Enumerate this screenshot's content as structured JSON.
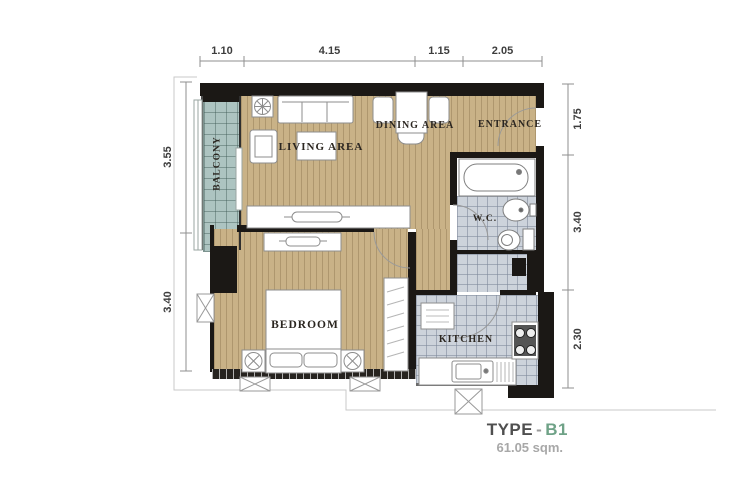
{
  "floorplan": {
    "footer": {
      "type_label": "TYPE",
      "separator": "-",
      "type_value": "B1",
      "area": "61.05 sqm."
    },
    "rooms": {
      "balcony": "BALCONY",
      "living": "LIVING AREA",
      "dining": "DINING AREA",
      "entrance": "ENTRANCE",
      "wc": "W.C.",
      "bedroom": "BEDROOM",
      "kitchen": "KITCHEN"
    },
    "dimensions": {
      "top": [
        "1.10",
        "4.15",
        "1.15",
        "2.05"
      ],
      "left": [
        "3.55",
        "3.40"
      ],
      "right": [
        "1.75",
        "3.40",
        "2.30"
      ]
    },
    "colors": {
      "wall": "#1b1815",
      "wood": "#c9b287",
      "balcony": "#adc4c1",
      "tile": "#cdd3db",
      "accent": "#6fa287",
      "dimtext": "#3d3d3d",
      "labeltext": "#2b2620"
    }
  }
}
